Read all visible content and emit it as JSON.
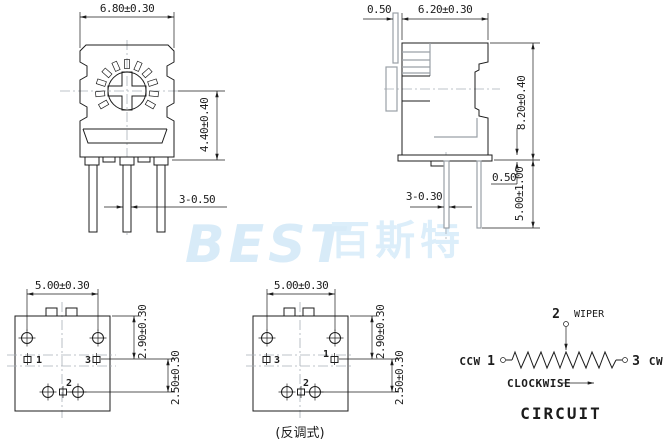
{
  "watermark": {
    "brand_latin": "BEST",
    "brand_cjk": "百斯特",
    "latin_color": "#d8ebf8",
    "cjk_color": "#dceefa"
  },
  "front_view": {
    "width_dim": "6.80±0.30",
    "height_dim": "4.40±0.40",
    "pin_width_dim": "3-0.50"
  },
  "side_view": {
    "flange_dim": "0.50",
    "depth_dim": "6.20±0.30",
    "height_dim": "8.20±0.40",
    "pin_width_dim": "3-0.30",
    "standoff_dim": "0.50",
    "pin_length_dim": "5.00±1.00"
  },
  "bottom_view_standard": {
    "pitch_dim": "5.00±0.30",
    "upper_row_dim": "2.90±0.30",
    "lower_row_dim": "2.50±0.30",
    "terminal_left": "1",
    "terminal_right": "3",
    "terminal_middle": "2"
  },
  "bottom_view_reverse": {
    "pitch_dim": "5.00±0.30",
    "upper_row_dim": "2.90±0.30",
    "lower_row_dim": "2.50±0.30",
    "terminal_left": "3",
    "terminal_right": "1",
    "terminal_middle": "2",
    "caption": "(反调式)"
  },
  "circuit": {
    "wiper_terminal": "2",
    "wiper_label": "WIPER",
    "ccw_label": "CCW",
    "ccw_terminal": "1",
    "cw_terminal": "3",
    "cw_label": "CW",
    "direction_label": "CLOCKWISE",
    "title": "CIRCUIT"
  },
  "colors": {
    "line": "#1c1c1c",
    "detail_gray": "#9aa0a6",
    "centerline": "#a9b0b8",
    "background": "#ffffff"
  }
}
